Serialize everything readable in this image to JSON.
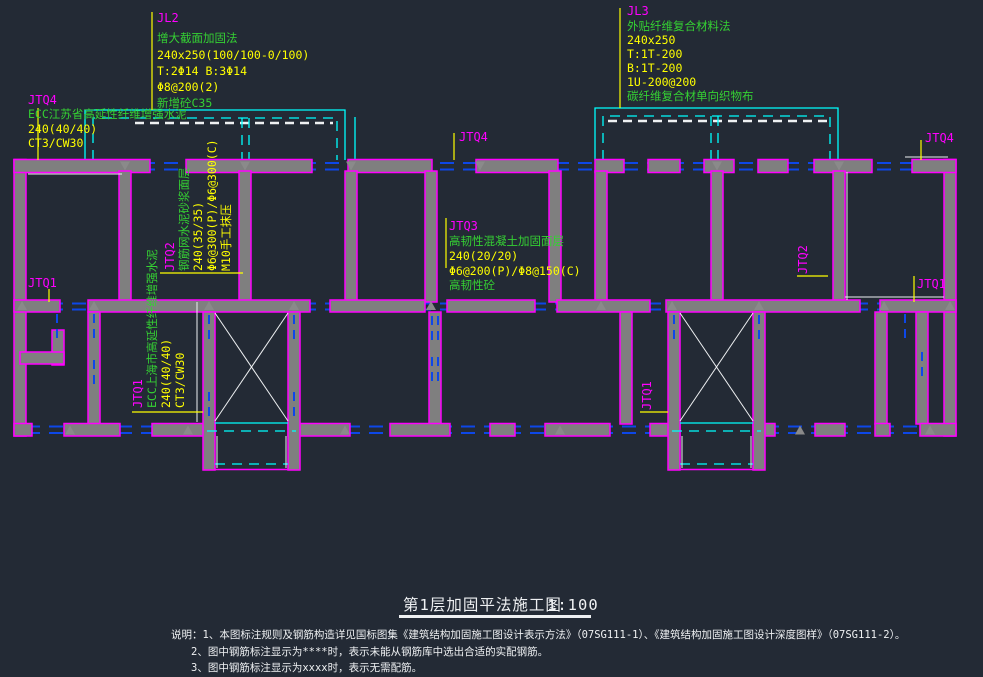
{
  "drawing": {
    "beams": {
      "jl2": {
        "id": "JL2",
        "method": "增大截面加固法",
        "spec": "240x250(100/100-0/100)",
        "rebar": "T:2Φ14 B:3Φ14",
        "stirrup": "Φ8@200(2)",
        "material": "新增砼C35"
      },
      "jl3": {
        "id": "JL3",
        "method": "外贴纤维复合材料法",
        "spec": "240x250",
        "top": "T:1T-200",
        "bottom": "B:1T-200",
        "wrap": "1U-200@200",
        "material": "碳纤维复合材单向织物布"
      }
    },
    "walls": {
      "jtq4": {
        "id": "JTQ4",
        "method": "ECC江苏省高延性纤维增强水泥",
        "spec": "240(40/40)",
        "grade": "CT3/CW30"
      },
      "jtq2": {
        "id": "JTQ2",
        "method": "钢筋网水泥砂浆面层",
        "spec": "240(35/35)",
        "rebar": "Φ6@300(P)/Φ6@300(C)",
        "note": "M10手工抹压"
      },
      "jtq1": {
        "id": "JTQ1",
        "method": "ECC上海市高延性纤维增强水泥",
        "spec": "240(40/40)",
        "grade": "CT3/CW30"
      },
      "jtq3": {
        "id": "JTQ3",
        "method": "高韧性混凝土加固面层",
        "spec": "240(20/20)",
        "rebar": "Φ6@200(P)/Φ8@150(C)",
        "material": "高韧性砼"
      }
    },
    "labels": {
      "jtq1": "JTQ1",
      "jtq2": "JTQ2",
      "jtq4": "JTQ4"
    },
    "title": {
      "text": "第1层加固平法施工图",
      "scale": "1:100"
    },
    "notes": [
      "说明：1、本图标注规则及钢筋构造详见国标图集《建筑结构加固施工图设计表示方法》（07SG111-1）、《建筑结构加固施工图设计深度图样》（07SG111-2）。",
      "2、图中钢筋标注显示为****时，表示未能从钢筋库中选出合适的实配钢筋。",
      "3、图中钢筋标注显示为xxxx时，表示无需配筋。"
    ],
    "colors": {
      "background": "#232a35",
      "wall_fill": "#7f7f7f",
      "wall_outline": "#ff00ff",
      "window_line": "#0d47e8",
      "construction_line": "#00ffff",
      "leader_line": "#ffff00",
      "label_text": "#ff00ff",
      "method_text": "#35d133",
      "spec_text": "#ffff00",
      "drawing_text": "#eef0f2"
    }
  }
}
